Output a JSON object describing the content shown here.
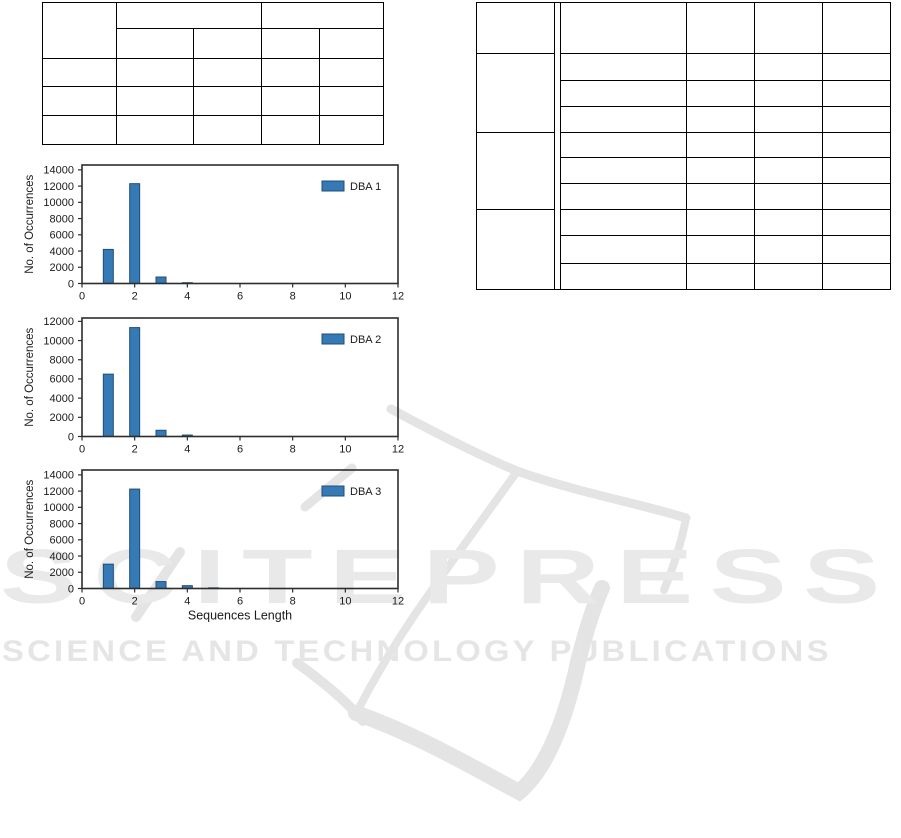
{
  "watermark": {
    "wordmark": "SCITEPRESS",
    "tagline": "SCIENCE AND TECHNOLOGY PUBLICATIONS",
    "text_color": "#e9e9e9",
    "logo_color": "#e4e4e4"
  },
  "chart_data": [
    {
      "type": "bar",
      "title": "",
      "categories": [
        1,
        2,
        3,
        4,
        5
      ],
      "series": [
        {
          "name": "DBA 1",
          "values": [
            4200,
            12300,
            800,
            100,
            0
          ]
        }
      ],
      "xlabel": "",
      "ylabel": "No. of Occurrences",
      "xlim": [
        0,
        12
      ],
      "ylim": [
        0,
        14600
      ],
      "xticks": [
        0,
        2,
        4,
        6,
        8,
        10,
        12
      ],
      "yticks": [
        0,
        2000,
        4000,
        6000,
        8000,
        10000,
        12000,
        14000
      ],
      "legend": {
        "label": "DBA 1",
        "position": "upper right"
      },
      "grid": false,
      "bar_color": "#3579b5",
      "bar_edge_color": "#1f4e79"
    },
    {
      "type": "bar",
      "title": "",
      "categories": [
        1,
        2,
        3,
        4,
        5
      ],
      "series": [
        {
          "name": "DBA 2",
          "values": [
            6500,
            11350,
            650,
            150,
            0
          ]
        }
      ],
      "xlabel": "",
      "ylabel": "No. of Occurrences",
      "xlim": [
        0,
        12
      ],
      "ylim": [
        0,
        12350
      ],
      "xticks": [
        0,
        2,
        4,
        6,
        8,
        10,
        12
      ],
      "yticks": [
        0,
        2000,
        4000,
        6000,
        8000,
        10000,
        12000
      ],
      "legend": {
        "label": "DBA 2",
        "position": "upper right"
      },
      "grid": false,
      "bar_color": "#3579b5",
      "bar_edge_color": "#1f4e79"
    },
    {
      "type": "bar",
      "title": "",
      "categories": [
        1,
        2,
        3,
        4,
        5
      ],
      "series": [
        {
          "name": "DBA 3",
          "values": [
            3000,
            12250,
            850,
            350,
            80
          ]
        }
      ],
      "xlabel": "Sequences Length",
      "ylabel": "No. of Occurrences",
      "xlim": [
        0,
        12
      ],
      "ylim": [
        0,
        14600
      ],
      "xticks": [
        0,
        2,
        4,
        6,
        8,
        10,
        12
      ],
      "yticks": [
        0,
        2000,
        4000,
        6000,
        8000,
        10000,
        12000,
        14000
      ],
      "legend": {
        "label": "DBA 3",
        "position": "upper right"
      },
      "grid": false,
      "bar_color": "#3579b5",
      "bar_edge_color": "#1f4e79"
    }
  ]
}
